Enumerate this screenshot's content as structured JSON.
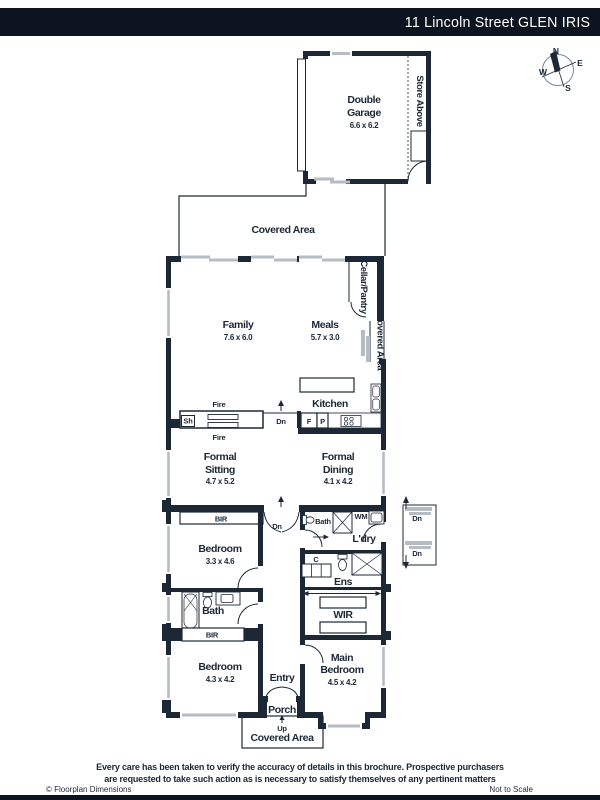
{
  "header": {
    "title": "11 Lincoln Street GLEN IRIS"
  },
  "compass": {
    "n": "N",
    "e": "E",
    "w": "W",
    "s": "S"
  },
  "plan": {
    "garage": {
      "line1": "Double",
      "line2": "Garage",
      "dims": "6.6 x 6.2"
    },
    "store_above": "Store Above",
    "covered_area_top": "Covered Area",
    "family": {
      "name": "Family",
      "dims": "7.6 x 6.0"
    },
    "meals": {
      "name": "Meals",
      "dims": "5.7 x 3.0"
    },
    "cellar_pantry": "Cellar/Pantry",
    "covered_area_right": "Covered Area",
    "kitchen": "Kitchen",
    "formal_sitting": {
      "line1": "Formal",
      "line2": "Sitting",
      "dims": "4.7 x 5.2"
    },
    "formal_dining": {
      "line1": "Formal",
      "line2": "Dining",
      "dims": "4.1 x 4.2"
    },
    "bedroom2": {
      "name": "Bedroom",
      "dims": "3.3 x 4.6"
    },
    "bath_mid": "Bath",
    "laundry": "L'dry",
    "ens": "Ens",
    "wir": "WIR",
    "bath_lower": "Bath",
    "bedroom3": {
      "name": "Bedroom",
      "dims": "4.3 x 4.2"
    },
    "entry": "Entry",
    "porch": "Porch",
    "covered_area_bottom": "Covered Area",
    "main_bedroom": {
      "line1": "Main",
      "line2": "Bedroom",
      "dims": "4.5 x 4.2"
    },
    "markers": {
      "fire": "Fire",
      "sh": "Sh",
      "dn": "Dn",
      "up": "Up",
      "fridge": "F",
      "pantry": "P",
      "wm": "WM",
      "cupboard": "C",
      "bir": "BIR"
    }
  },
  "footer": {
    "disclaimer_line1": "Every care has been taken to verify the accuracy of details in this brochure. Prospective purchasers",
    "disclaimer_line2": "are requested to take such action as is necessary to satisfy themselves of any pertinent matters",
    "copyright": "© Floorplan Dimensions",
    "scale_note": "Not to Scale"
  },
  "colors": {
    "wall": "#1c2836",
    "header_bg": "#0c1420",
    "hardware_gray": "#b6bcc4"
  }
}
